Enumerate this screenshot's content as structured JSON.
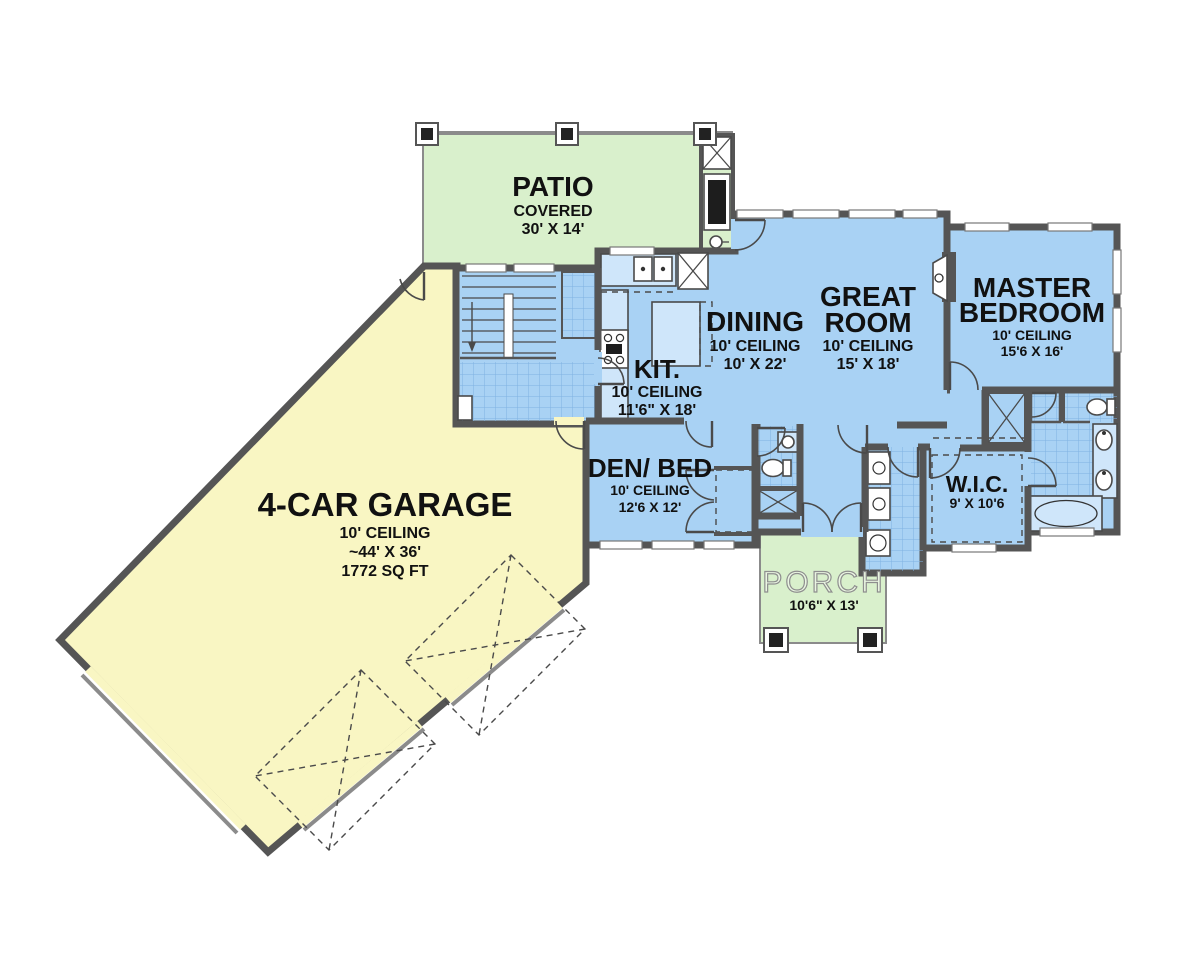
{
  "plan_title": "single-story-floor-plan",
  "colors": {
    "patio_green": "#d9f0cc",
    "porch_green": "#d9f0cc",
    "garage_yellow": "#f9f6c3",
    "house_blue": "#a9d2f4",
    "tile_line_blue": "#7fb2e2",
    "counter_blue": "#cfe6fa",
    "wall_gray": "#555555"
  },
  "rooms": {
    "patio": {
      "name": "PATIO",
      "type": "COVERED",
      "dims": "30' X 14'"
    },
    "garage": {
      "name": "4-CAR GARAGE",
      "ceiling": "10' CEILING",
      "dims": "~44' X 36'",
      "area": "1772 SQ FT"
    },
    "kitchen": {
      "name": "KIT.",
      "ceiling": "10' CEILING",
      "dims": "11'6\" X 18'"
    },
    "dining": {
      "name": "DINING",
      "ceiling": "10' CEILING",
      "dims": "10' X 22'"
    },
    "great_room": {
      "name_line1": "GREAT",
      "name_line2": "ROOM",
      "ceiling": "10' CEILING",
      "dims": "15' X 18'"
    },
    "master_bedroom": {
      "name_line1": "MASTER",
      "name_line2": "BEDROOM",
      "ceiling": "10' CEILING",
      "dims": "15'6 X 16'"
    },
    "den_bed": {
      "name": "DEN/ BED",
      "ceiling": "10' CEILING",
      "dims": "12'6 X 12'"
    },
    "wic": {
      "name": "W.I.C.",
      "dims": "9' X 10'6"
    },
    "porch": {
      "name": "PORCH",
      "dims": "10'6\" X 13'"
    }
  }
}
